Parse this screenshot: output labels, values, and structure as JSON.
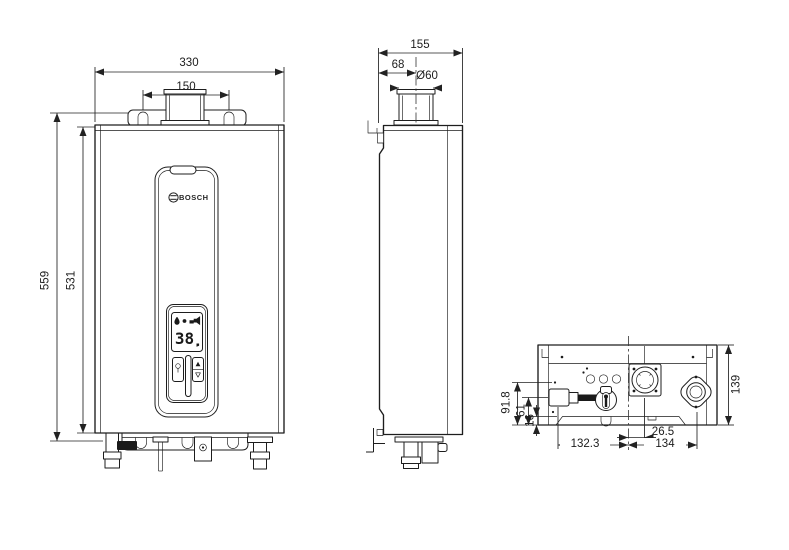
{
  "colors": {
    "line": "#1d1d1d",
    "background": "#ffffff"
  },
  "front_view": {
    "logo": "BOSCH",
    "display": {
      "temperature": "38"
    },
    "dims": {
      "overall_width": "330",
      "flue_bracket_spacing": "150",
      "overall_height": "559",
      "cabinet_height": "531"
    }
  },
  "side_view": {
    "dims": {
      "overall_depth": "155",
      "flue_center_offset": "68",
      "flue_diameter": "Ø60"
    }
  },
  "bottom_view": {
    "dims": {
      "overall_depth": "139",
      "inlet_height": "91.8",
      "inlet_center_height": "61",
      "front_lip": "16",
      "gas_center_offset": "26.5",
      "left_span": "132.3",
      "right_span": "134"
    }
  },
  "icons": {
    "display": [
      "water-drop-icon",
      "burner-icon",
      "faucet-icon"
    ],
    "buttons": [
      "power-icon",
      "up-arrow-icon",
      "down-arrow-icon"
    ],
    "emblem": "bosch-emblem-icon"
  }
}
